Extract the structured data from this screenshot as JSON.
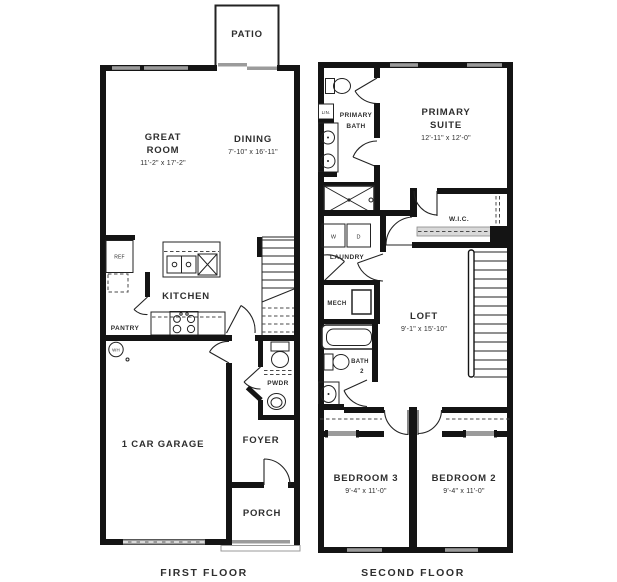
{
  "colors": {
    "wall": "#141414",
    "window_gray": "#9b9b9b",
    "text": "#2e2e2e",
    "background": "#ffffff"
  },
  "first_floor": {
    "caption": "FIRST FLOOR",
    "patio": "PATIO",
    "great_room": {
      "l1": "GREAT",
      "l2": "ROOM",
      "dims": "11'-2\" x 17'-2\""
    },
    "dining": {
      "name": "DINING",
      "dims": "7'-10\" x 16'-11\""
    },
    "kitchen": "KITCHEN",
    "ref": "REF",
    "pantry": "PANTRY",
    "wh": "WH",
    "garage": "1 CAR GARAGE",
    "pwdr": "PWDR",
    "foyer": "FOYER",
    "porch": "PORCH"
  },
  "second_floor": {
    "caption": "SECOND FLOOR",
    "primary_bath": {
      "l1": "PRIMARY",
      "l2": "BATH"
    },
    "lin": "LIN.",
    "primary_suite": {
      "l1": "PRIMARY",
      "l2": "SUITE",
      "dims": "12'-11\" x 12'-0\""
    },
    "wic": "W.I.C.",
    "laundry": {
      "name": "LAUNDRY",
      "w": "W",
      "d": "D"
    },
    "mech": "MECH",
    "loft": {
      "name": "LOFT",
      "dims": "9'-1\" x 15'-10\""
    },
    "bath2": {
      "l1": "BATH",
      "l2": "2"
    },
    "bedroom3": {
      "name": "BEDROOM 3",
      "dims": "9'-4\" x 11'-0\""
    },
    "bedroom2": {
      "name": "BEDROOM 2",
      "dims": "9'-4\" x 11'-0\""
    }
  }
}
